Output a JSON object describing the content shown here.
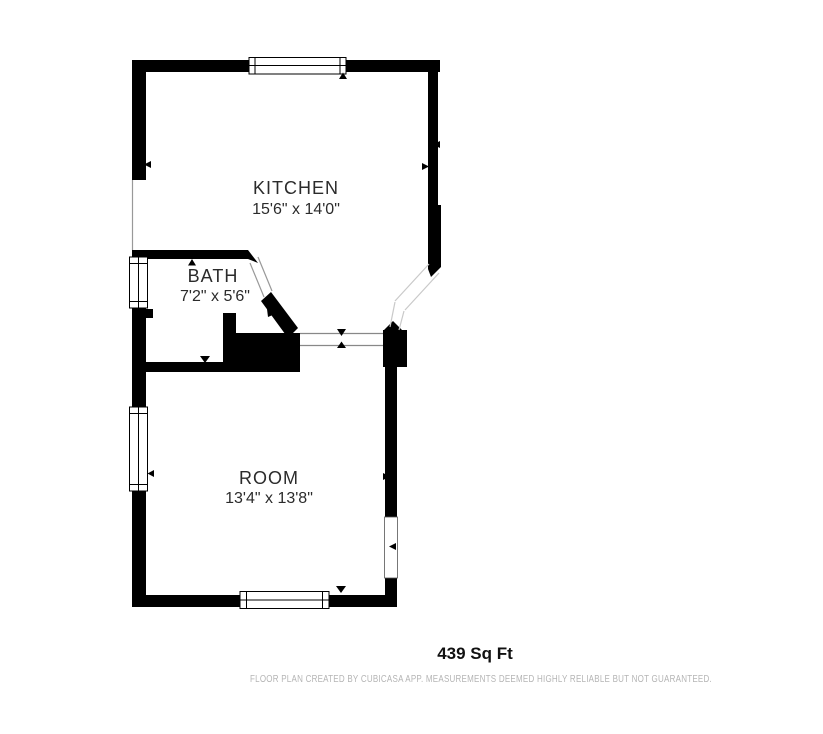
{
  "floor_plan": {
    "rooms": [
      {
        "name": "KITCHEN",
        "dimensions": "15'6\" x 14'0\""
      },
      {
        "name": "BATH",
        "dimensions": "7'2\" x 5'6\""
      },
      {
        "name": "ROOM",
        "dimensions": "13'4\" x 13'8\""
      }
    ],
    "total_area": "439 Sq Ft",
    "footer": "FLOOR PLAN CREATED BY CUBICASA APP. MEASUREMENTS DEEMED HIGHLY RELIABLE BUT NOT GUARANTEED.",
    "colors": {
      "wall": "#000000",
      "background": "#ffffff",
      "label_text": "#2b2b2b",
      "area_text": "#111111",
      "footer_text": "#b5b5b5",
      "opening_line": "#999999",
      "door_line": "#c9c9c9",
      "threshold_line": "#888888"
    }
  }
}
